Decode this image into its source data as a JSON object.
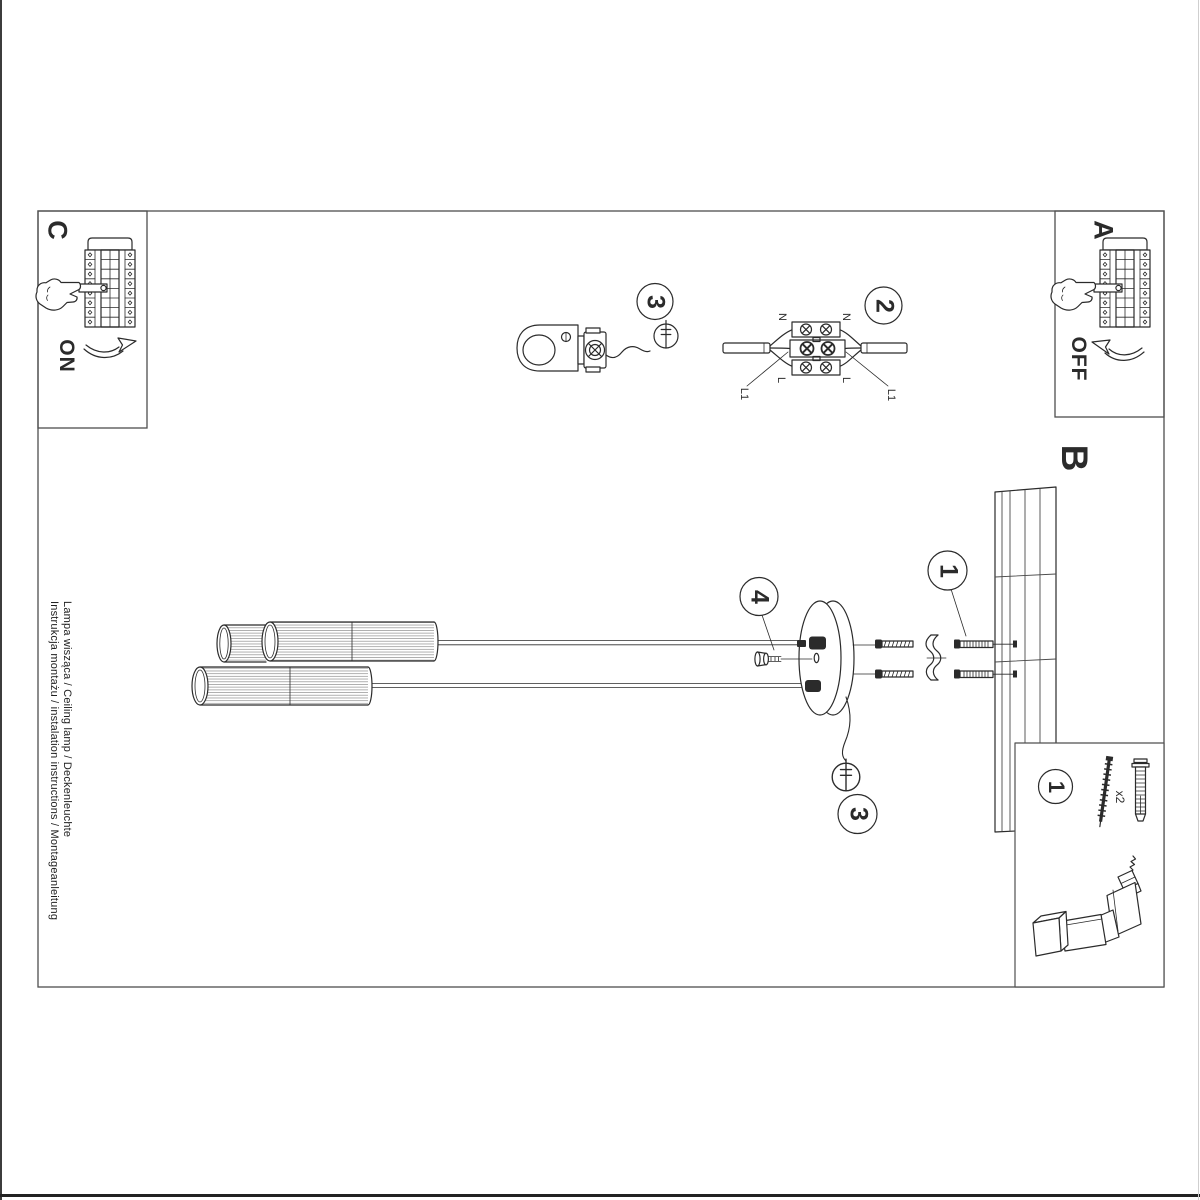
{
  "labels": {
    "section_a": "A",
    "section_b": "B",
    "section_c": "C",
    "switch_on": "ON",
    "switch_off": "OFF"
  },
  "step_numbers": {
    "strain_relief": "3",
    "terminal_block": "2",
    "canopy_bolt": "4",
    "wall_mounting": "1",
    "canopy_wire": "3",
    "parts_list": "1"
  },
  "terminal_labels": {
    "neutral_left": "N",
    "neutral_right": "N",
    "live_left": "L",
    "live_right": "L",
    "line1_left": "L1",
    "line1_right": "L1"
  },
  "parts_box": {
    "quantity": "x2"
  },
  "footer": {
    "title_line1": "Instrukcja montażu / instalation instructions / Montageanleitung",
    "title_line2": "Lampa wisząca / Ceiling lamp / Deckenleuchte"
  },
  "colors": {
    "ink": "#2b2b2b",
    "border": "#4f4f4f",
    "hatch": "#6f6f6f"
  }
}
